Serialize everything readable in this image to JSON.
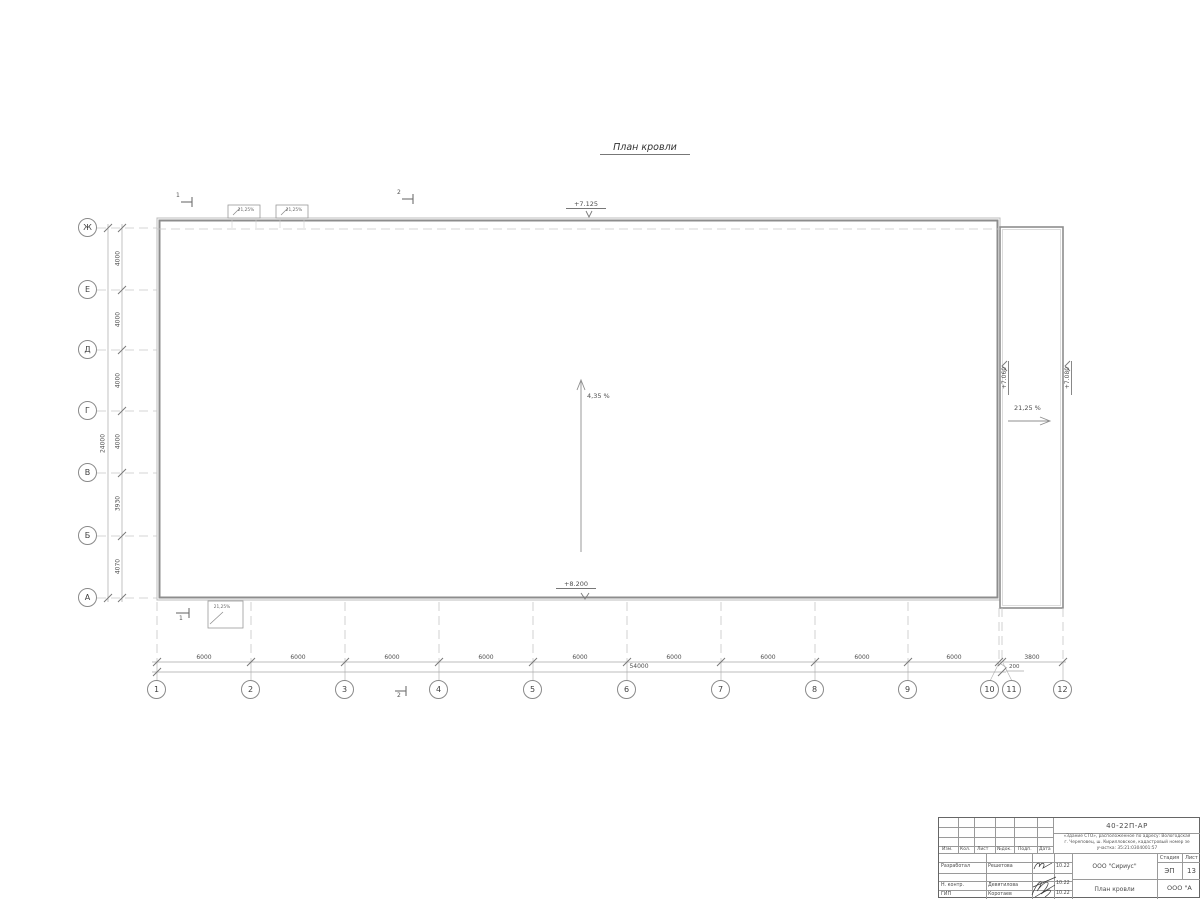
{
  "title": "План кровли",
  "axes": {
    "rows": [
      "Ж",
      "Е",
      "Д",
      "Г",
      "В",
      "Б",
      "А"
    ],
    "cols": [
      "1",
      "2",
      "3",
      "4",
      "5",
      "6",
      "7",
      "8",
      "9",
      "10",
      "11",
      "12"
    ],
    "row_dims": [
      "4000",
      "4000",
      "4000",
      "4000",
      "3930",
      "4070"
    ],
    "row_total": "24000",
    "col_dims": [
      "6000",
      "6000",
      "6000",
      "6000",
      "6000",
      "6000",
      "6000",
      "6000",
      "6000"
    ],
    "col_dim_small": "200",
    "col_dim_right": "3800",
    "col_total": "54000"
  },
  "annotations": {
    "slope_main": "4,35 %",
    "slope_right": "21,25 %",
    "slope_box": "21,25%",
    "elev_top": "+7.125",
    "elev_bottom": "+8.200",
    "elev_right_inner": "+7.060",
    "elev_right_outer": "+7.080",
    "section_1": "1",
    "section_2": "2"
  },
  "titleblock": {
    "doc_number": "40-22П-АР",
    "address_line1": "«Здание СТО», расположенное по адресу: Вологодская",
    "address_line2": "г. Череповец, ш. Кирилловское, кадастровый номер зе",
    "address_line3": "участка: 35:21:0304001:57",
    "header_cells": [
      "Изм.",
      "Кол.",
      "Лист",
      "№док.",
      "Подп.",
      "Дата"
    ],
    "rows": [
      {
        "role": "Разработал",
        "name": "Решетова",
        "date": "10.22"
      },
      {
        "role": "Н. контр.",
        "name": "Девятилова",
        "date": "10.22"
      },
      {
        "role": "ГИП",
        "name": "Коротаев",
        "date": "10.22"
      }
    ],
    "org": "ООО \"Сириус\"",
    "sheet_title": "План кровли",
    "stage_label": "Стадия",
    "sheet_label": "Лист",
    "stage": "ЭП",
    "sheet": "13",
    "org2": "ООО \"А"
  }
}
